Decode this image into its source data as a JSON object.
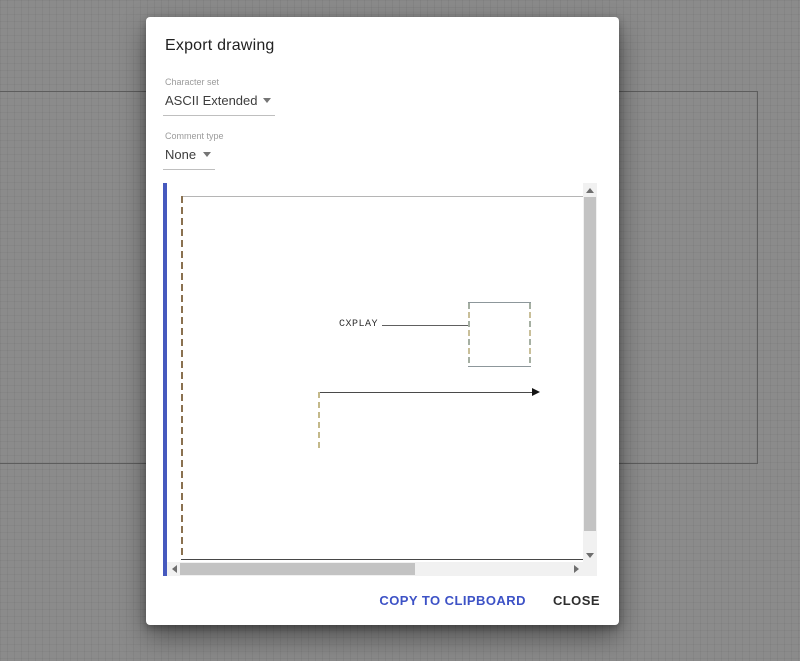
{
  "dialog": {
    "title": "Export drawing",
    "character_set": {
      "label": "Character set",
      "value": "ASCII Extended"
    },
    "comment_type": {
      "label": "Comment type",
      "value": "None"
    },
    "actions": {
      "copy": "COPY TO CLIPBOARD",
      "close": "CLOSE"
    }
  },
  "preview": {
    "box_label": "CXPLAY",
    "elements": [
      "large dashed-left frame spanning the preview",
      "small box with dashed sides labeled CXPLAY via connector line",
      "right-pointing arrow with dashed vertical tail"
    ]
  },
  "icons": {
    "dropdown_caret": "chevron-down",
    "scrollbar_up": "triangle-up",
    "scrollbar_down": "triangle-down",
    "scrollbar_left": "triangle-left",
    "scrollbar_right": "triangle-right",
    "arrowhead": "triangle-right"
  },
  "colors": {
    "accent_blue": "#3d52c6",
    "selection_bar_blue": "#4659be",
    "frame_dash_brown": "#8a7150",
    "box_dash_green": "#a5afa2",
    "box_dash_tan": "#c9bf99",
    "arrow_dash_tan": "#c4b98a",
    "canvas_gray": "#8b8b8b",
    "dialog_bg": "#ffffff"
  }
}
